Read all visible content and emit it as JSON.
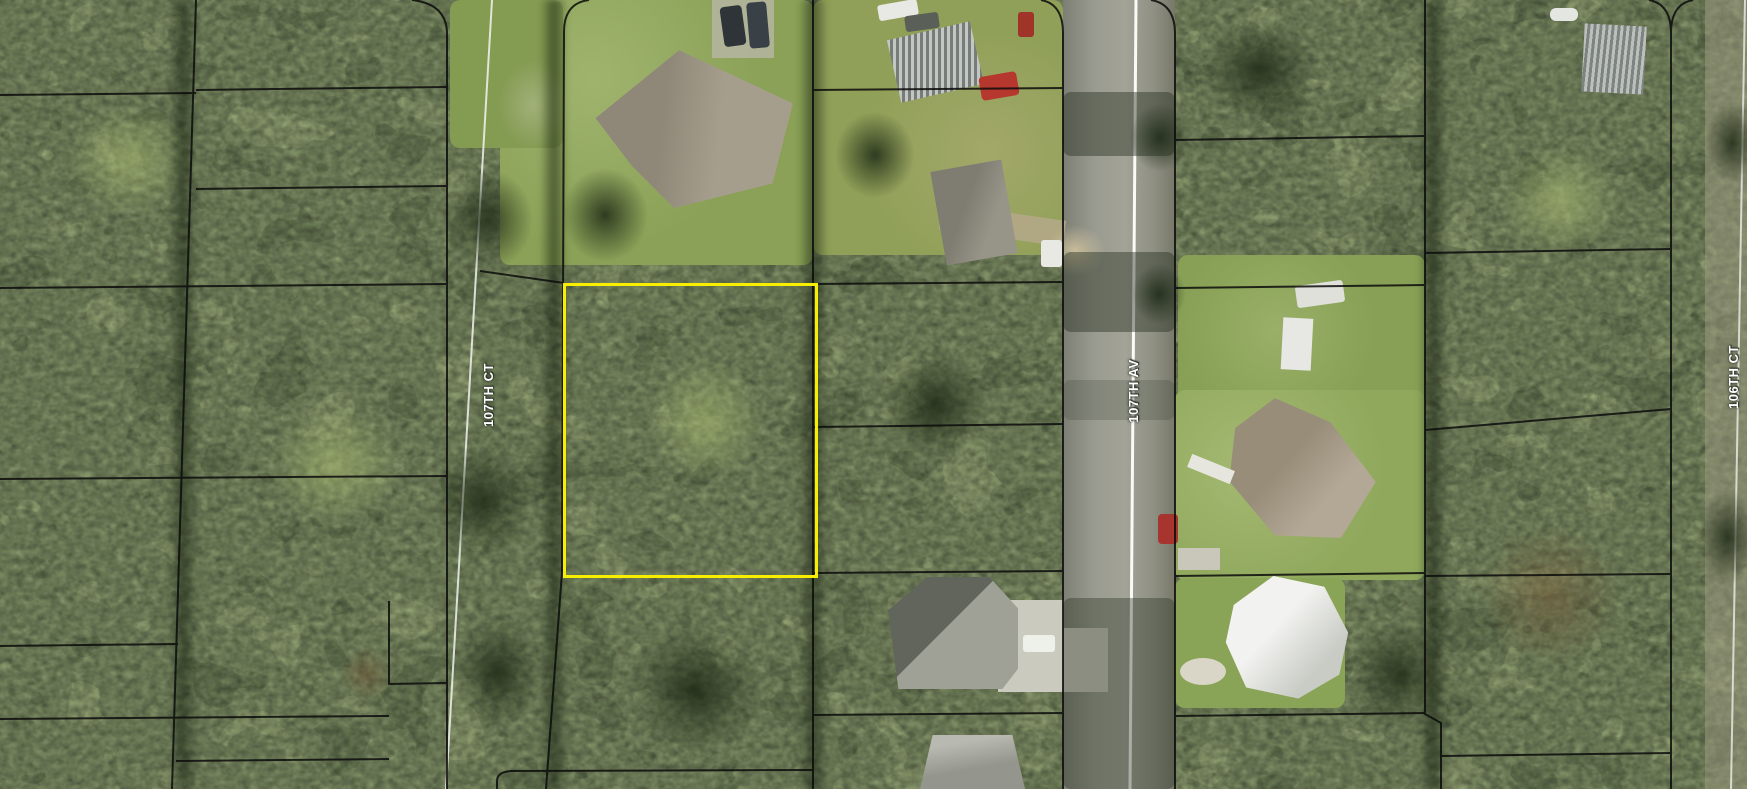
{
  "map": {
    "description": "Aerial parcel map with a highlighted vacant lot among wooded residential parcels",
    "streets": [
      {
        "id": "107th-ct",
        "label": "107TH CT"
      },
      {
        "id": "107th-av",
        "label": "107TH AV"
      },
      {
        "id": "106th-ct",
        "label": "106TH CT"
      }
    ],
    "highlighted_parcel": {
      "outline_color": "#f8ee00",
      "x": 563,
      "y": 283,
      "width": 249,
      "height": 289
    },
    "style": {
      "parcel_line_color": "#0c0c0c",
      "street_label_color": "#ffffff",
      "street_label_halo": "#32382e",
      "road_centerline_color": "#f7f7f2",
      "canopy_green_dark": "#2e3b22",
      "canopy_green_light": "#90a35c",
      "asphalt_gray": "#96978b"
    }
  }
}
